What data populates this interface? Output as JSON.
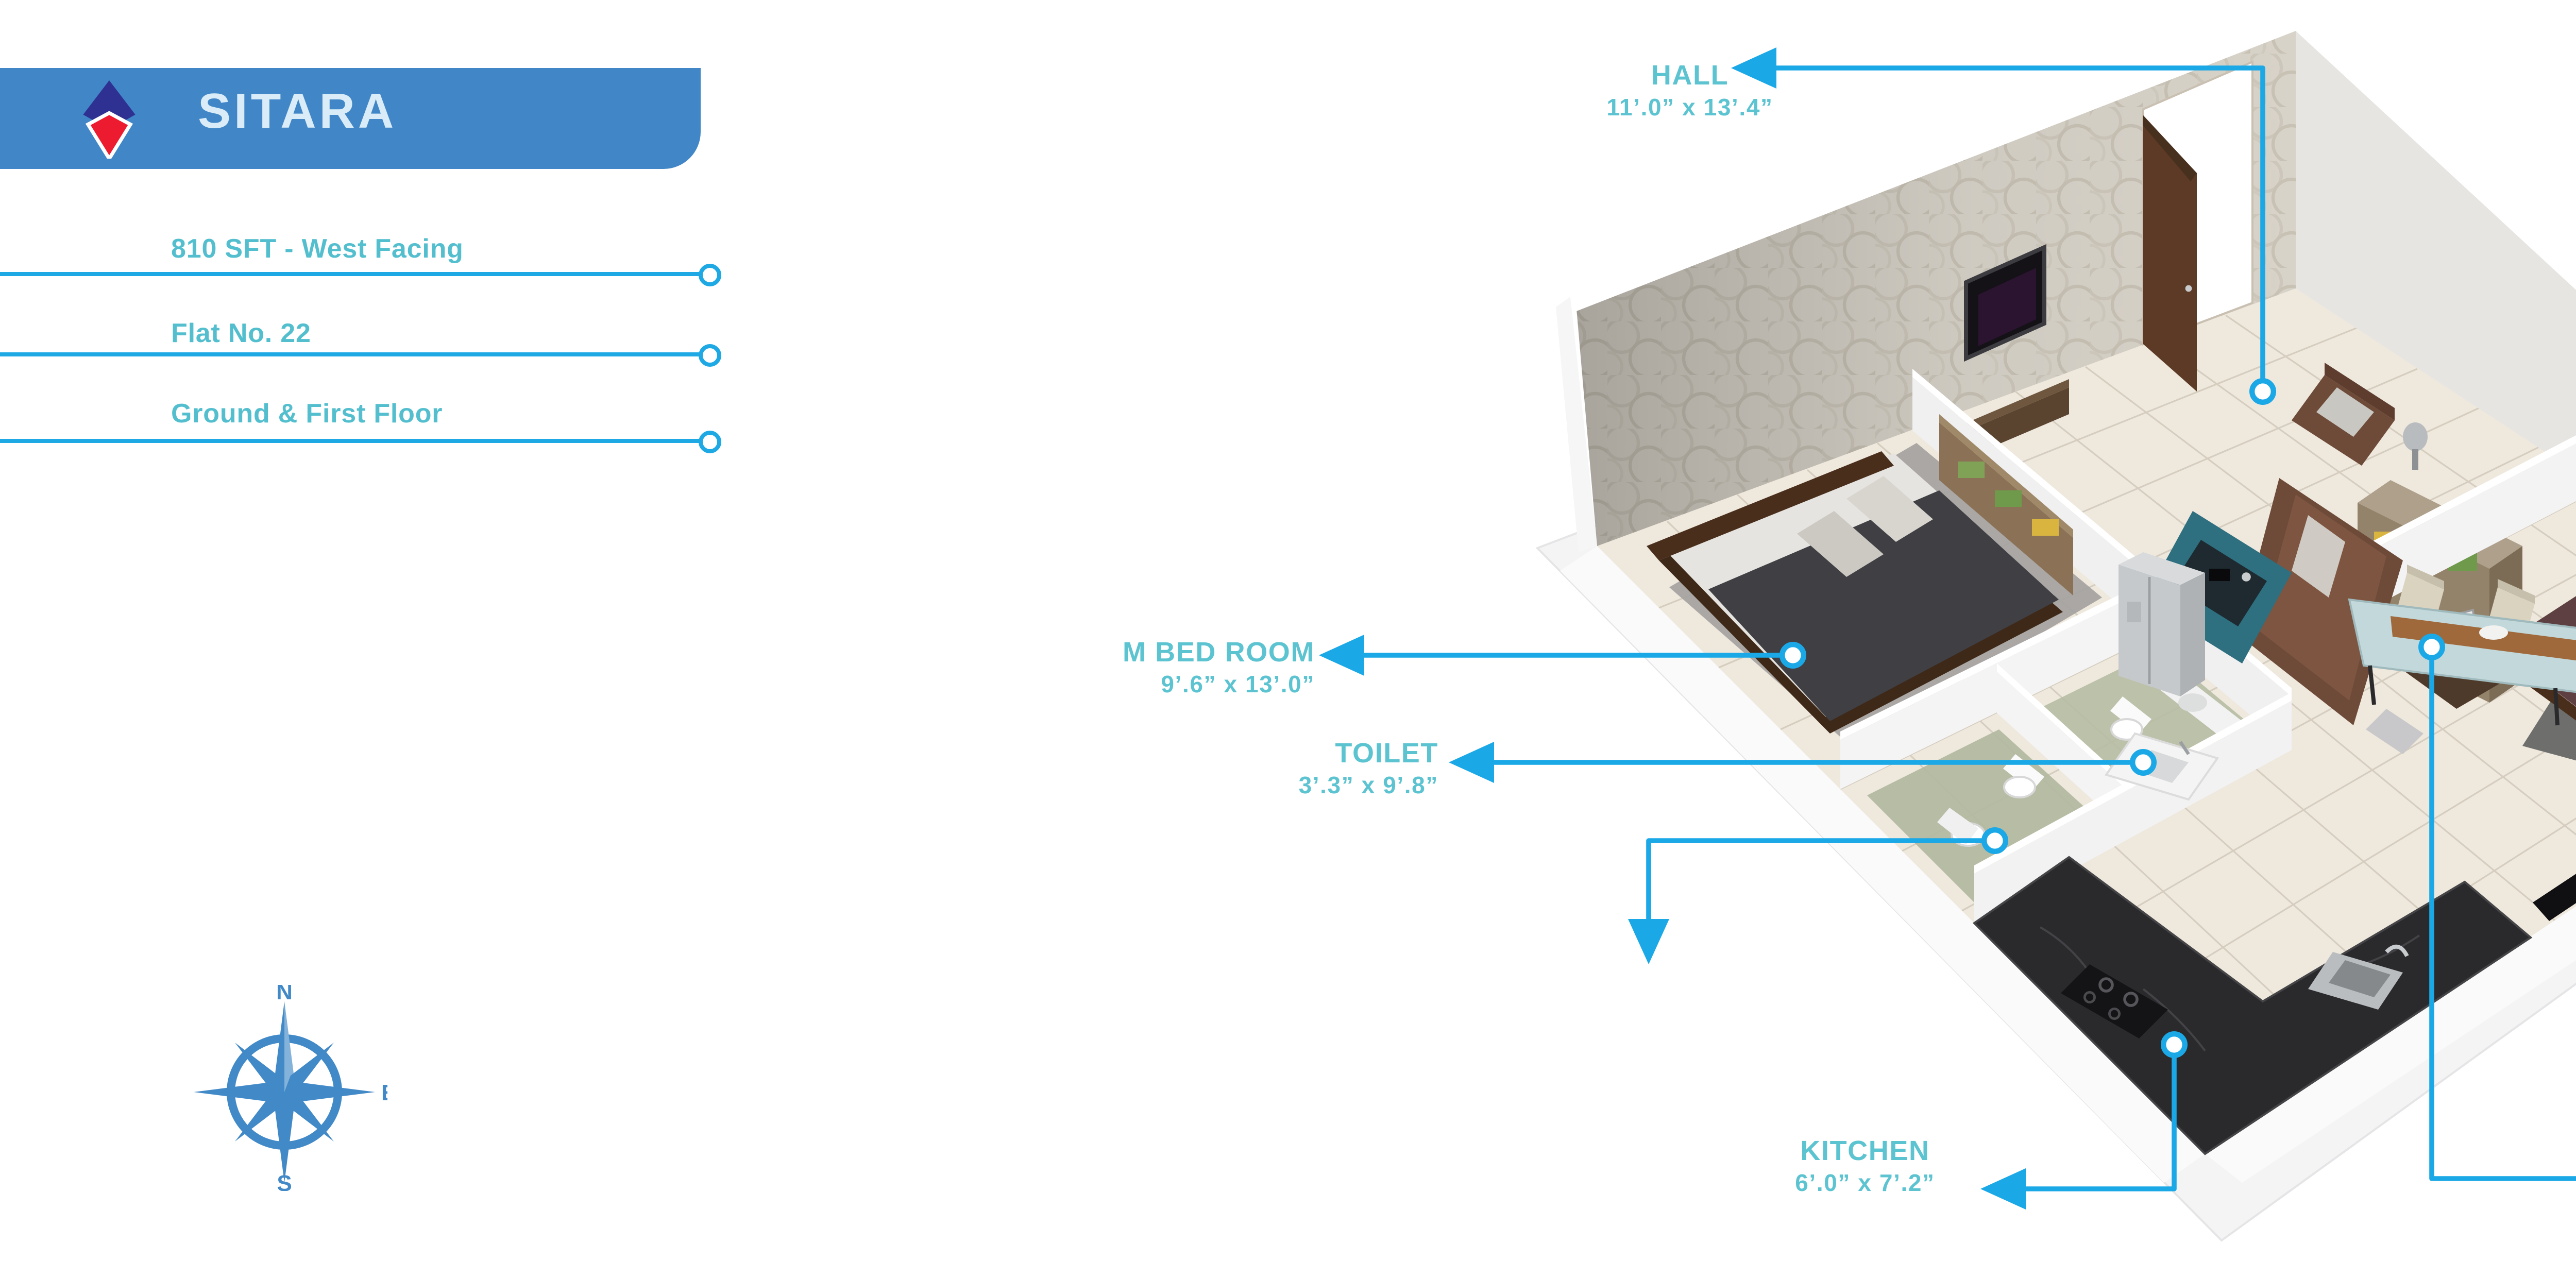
{
  "header": {
    "brand": "SITARA",
    "area_facing": "810 SFT - West Facing",
    "flat_no": "Flat No. 22",
    "floors": "Ground & First Floor",
    "banner_color": "#4187C7",
    "brand_text_color": "#D9ECF8",
    "logo_navy": "#2E3192",
    "logo_red": "#ED1B2F"
  },
  "info_rule_color": "#1EA9E4",
  "label_text_color": "#5CC3D1",
  "leader_color": "#1BA8E6",
  "compass": {
    "n": "N",
    "e": "E",
    "s": "S",
    "color": "#4189C7"
  },
  "rooms": [
    {
      "id": "hall",
      "name": "HALL",
      "dims": "11’.0” x 13’.4”"
    },
    {
      "id": "c-bed",
      "name": "C BED ROOM",
      "dims": "11’.8” x 9’.0”"
    },
    {
      "id": "m-bed",
      "name": "M BED ROOM",
      "dims": "9’.6” x 13’.0”"
    },
    {
      "id": "toilet",
      "name": "TOILET",
      "dims": "3’.3” x 9’.8”"
    },
    {
      "id": "kitchen",
      "name": "KITCHEN",
      "dims": "6’.0” x 7’.2”"
    },
    {
      "id": "dining",
      "name": "DINING",
      "dims": "9’.10” x 7’.4”"
    }
  ]
}
